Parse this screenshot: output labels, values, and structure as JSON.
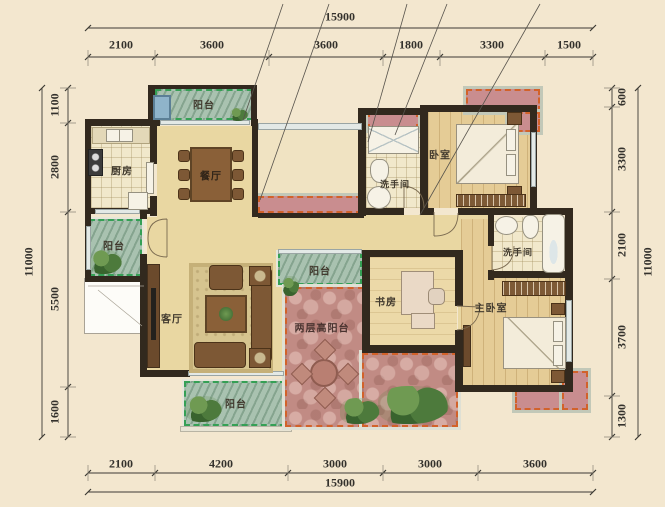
{
  "drawing": {
    "type": "residential-floor-plan",
    "units": "mm"
  },
  "dims": {
    "top": {
      "total": "15900",
      "segments": [
        "2100",
        "3600",
        "3600",
        "1800",
        "3300",
        "1500"
      ]
    },
    "bottom": {
      "total": "15900",
      "segments": [
        "2100",
        "4200",
        "3000",
        "3000",
        "3600"
      ]
    },
    "left": {
      "total": "11000",
      "segments": [
        "1100",
        "2800",
        "5500",
        "1600"
      ]
    },
    "right": {
      "total": "11000",
      "segments": [
        "600",
        "3300",
        "2100",
        "3700",
        "1300"
      ]
    }
  },
  "rooms": {
    "balcony_top": "阳台",
    "kitchen": "厨房",
    "dining": "餐厅",
    "bath1": "洗手间",
    "bedroom1": "卧室",
    "balcony_left": "阳台",
    "living": "客厅",
    "balcony_mid": "阳台",
    "double_height_balcony": "两层高阳台",
    "study": "书房",
    "bath2": "洗手间",
    "master_bedroom": "主卧室",
    "balcony_bottom": "阳台"
  },
  "colors": {
    "background": "#f3e7cf",
    "wall": "#32291e",
    "floor_tan": "#e9d7a2",
    "floor_wood": "#e5cc96",
    "balcony_green": "#a9c2b0",
    "balcony_green_dash": "#35a055",
    "stone_pink": "#c18b84",
    "planter_pink": "#c98d8f",
    "planter_dash_orange": "#d2622a",
    "furniture_brown": "#7d5835",
    "dimension_text": "#33312c"
  }
}
